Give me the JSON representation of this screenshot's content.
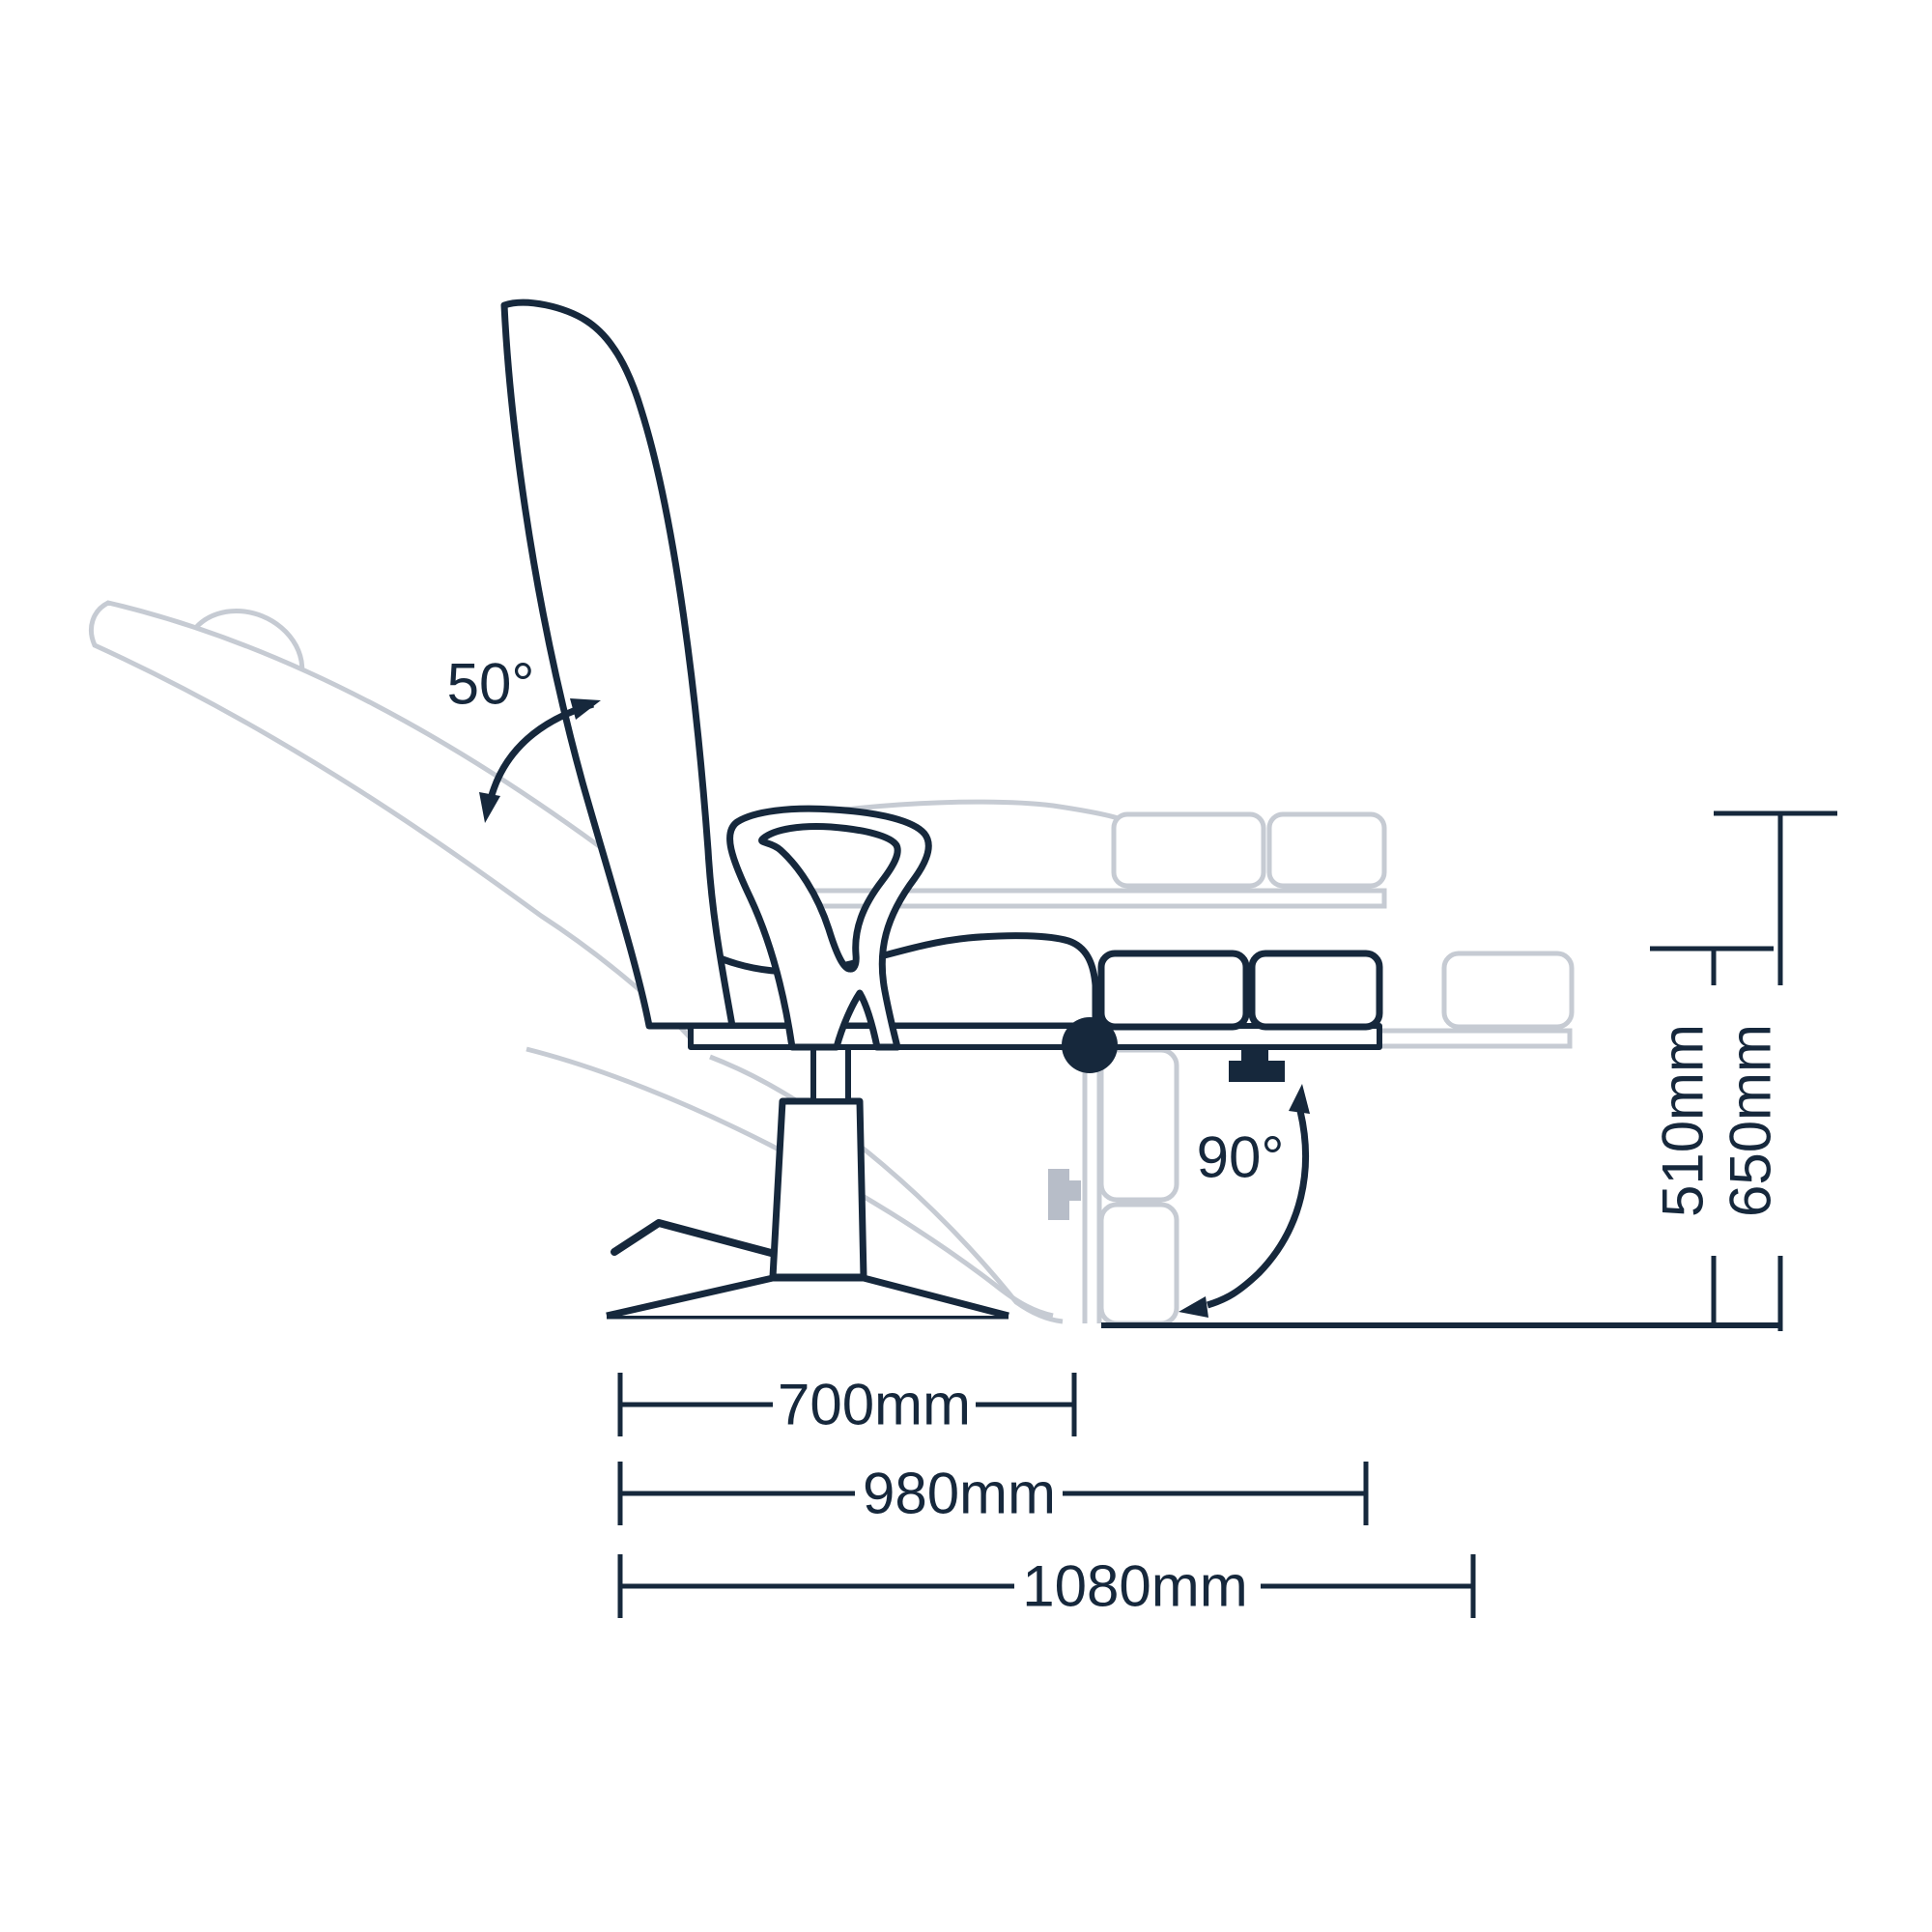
{
  "diagram": {
    "type": "technical-dimension-drawing",
    "subject": "reclining treatment chair side view with recline, legrest and size dimensions",
    "colors": {
      "line_dark": "#16283c",
      "line_ghost": "#c6cbd3",
      "knob_fill": "#b7bdc8",
      "background": "#ffffff"
    },
    "labels": {
      "angle_backrest": "50°",
      "angle_legrest": "90°",
      "width_base": "700mm",
      "width_mid": "980mm",
      "width_full": "1080mm",
      "height_low": "510mm",
      "height_high": "650mm"
    },
    "measurements": {
      "backrest_recline_deg": 50,
      "legrest_drop_deg": 90,
      "width_base_mm": 700,
      "width_mid_mm": 980,
      "width_full_mm": 1080,
      "seat_height_low_mm": 510,
      "seat_height_high_mm": 650
    }
  }
}
